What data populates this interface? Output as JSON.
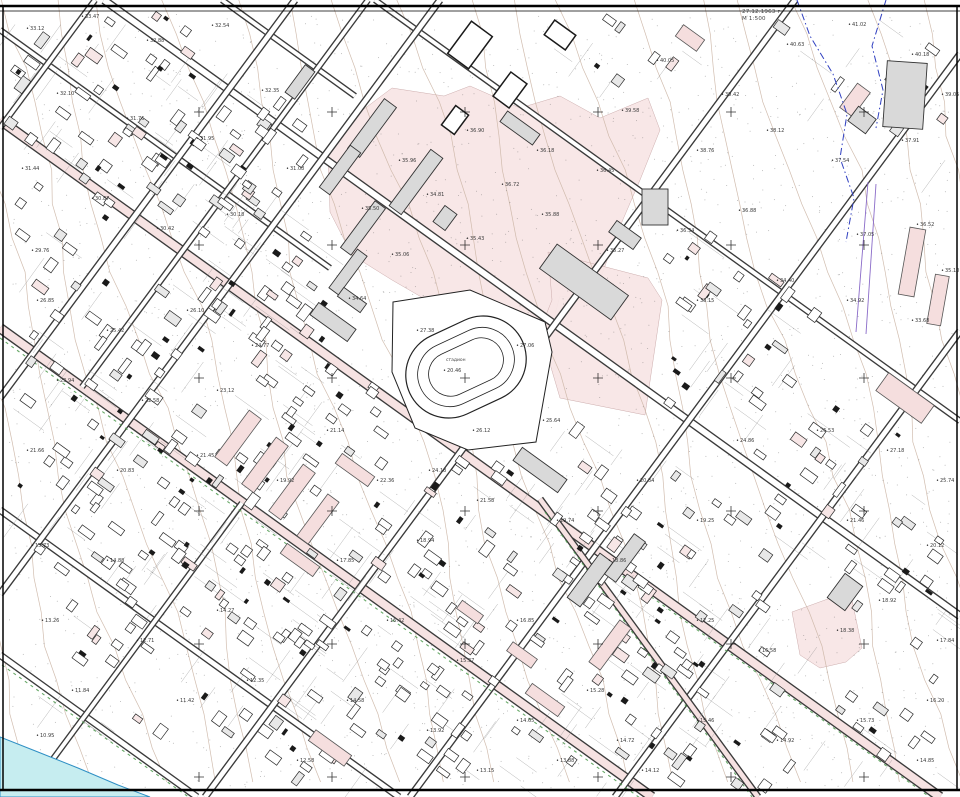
{
  "map": {
    "width": 960,
    "height": 797,
    "colors": {
      "background": "#ffffff",
      "zone_pink": "#f8e6e6",
      "road_tint": "#f6e2e2",
      "building_gray": "#d9d9d9",
      "building_outline": "#333333",
      "contour": "#ccb6a6",
      "water_fill": "#c6edf0",
      "water_edge": "#2e8fc4",
      "vegetation_green": "#4d9a4d",
      "boundary_blue": "#2f3fc0",
      "utility_purple": "#8a6bc8",
      "label_text": "#3b3b3b",
      "frame_black": "#000000"
    },
    "annotation": {
      "line1": "27.12.1963 г.",
      "line2": "М 1:500"
    },
    "stadium": {
      "label": "стадион",
      "center_elev": "20.46",
      "cx": 466,
      "cy": 367,
      "angle": -25,
      "rings": [
        [
          124,
          86
        ],
        [
          100,
          64
        ],
        [
          78,
          44
        ]
      ],
      "fence": [
        [
          393,
          302
        ],
        [
          470,
          290
        ],
        [
          545,
          322
        ],
        [
          552,
          352
        ],
        [
          536,
          442
        ],
        [
          468,
          450
        ],
        [
          415,
          428
        ],
        [
          392,
          372
        ]
      ]
    },
    "zones": [
      [
        [
          328,
          155
        ],
        [
          352,
          118
        ],
        [
          392,
          88
        ],
        [
          444,
          96
        ],
        [
          470,
          86
        ],
        [
          520,
          108
        ],
        [
          560,
          96
        ],
        [
          600,
          118
        ],
        [
          648,
          98
        ],
        [
          660,
          130
        ],
        [
          640,
          180
        ],
        [
          615,
          238
        ],
        [
          600,
          280
        ],
        [
          585,
          300
        ],
        [
          560,
          296
        ],
        [
          548,
          340
        ],
        [
          520,
          338
        ],
        [
          470,
          305
        ],
        [
          430,
          302
        ],
        [
          392,
          280
        ],
        [
          352,
          255
        ],
        [
          330,
          212
        ]
      ],
      [
        [
          548,
          252
        ],
        [
          648,
          278
        ],
        [
          662,
          300
        ],
        [
          645,
          415
        ],
        [
          560,
          398
        ],
        [
          540,
          330
        ],
        [
          552,
          300
        ]
      ],
      [
        [
          792,
          612
        ],
        [
          836,
          596
        ],
        [
          852,
          600
        ],
        [
          862,
          648
        ],
        [
          846,
          662
        ],
        [
          820,
          668
        ],
        [
          800,
          655
        ]
      ]
    ],
    "pink_bars": [
      [
        238,
        438,
        58,
        15,
        -53.5
      ],
      [
        265,
        465,
        58,
        15,
        -53.5
      ],
      [
        292,
        492,
        58,
        15,
        -53.5
      ],
      [
        318,
        519,
        52,
        14,
        -53.5
      ],
      [
        355,
        470,
        40,
        12,
        35.8
      ],
      [
        300,
        560,
        40,
        12,
        35.8
      ],
      [
        330,
        748,
        44,
        13,
        35.8
      ],
      [
        545,
        700,
        40,
        12,
        35.8
      ],
      [
        610,
        645,
        52,
        14,
        -53.5
      ],
      [
        470,
        612,
        26,
        10,
        35.8
      ],
      [
        522,
        655,
        30,
        11,
        35.8
      ],
      [
        912,
        262,
        16,
        68,
        10
      ],
      [
        938,
        300,
        14,
        50,
        10
      ],
      [
        905,
        398,
        56,
        22,
        35.8
      ],
      [
        855,
        100,
        30,
        16,
        -53.5
      ],
      [
        690,
        38,
        26,
        14,
        35.8
      ]
    ],
    "gray_buildings": [
      [
        372,
        128,
        62,
        15,
        -53.5
      ],
      [
        340,
        170,
        52,
        13,
        -53.5
      ],
      [
        416,
        182,
        70,
        15,
        -53.5
      ],
      [
        363,
        228,
        58,
        13,
        -53.5
      ],
      [
        348,
        272,
        48,
        12,
        -53.5
      ],
      [
        300,
        82,
        34,
        12,
        -53.5
      ],
      [
        445,
        218,
        20,
        15,
        -53.5
      ],
      [
        520,
        128,
        40,
        13,
        35.8
      ],
      [
        584,
        282,
        88,
        30,
        35.8
      ],
      [
        625,
        235,
        30,
        14,
        35.8
      ],
      [
        655,
        207,
        26,
        36,
        0
      ],
      [
        905,
        95,
        40,
        66,
        4
      ],
      [
        862,
        120,
        18,
        22,
        -53.5
      ],
      [
        333,
        322,
        46,
        15,
        35.8
      ],
      [
        352,
        300,
        28,
        11,
        35.8
      ],
      [
        845,
        592,
        30,
        22,
        -53.5
      ],
      [
        590,
        580,
        55,
        16,
        -53.5
      ],
      [
        625,
        558,
        50,
        14,
        -53.5
      ],
      [
        540,
        470,
        55,
        16,
        35.8
      ]
    ],
    "outline_buildings": [
      [
        470,
        45,
        40,
        26,
        -53.5
      ],
      [
        510,
        90,
        30,
        20,
        -53.5
      ],
      [
        455,
        120,
        24,
        16,
        -53.5
      ],
      [
        560,
        35,
        26,
        18,
        35.8
      ]
    ],
    "streets": [
      {
        "pts": [
          [
            104,
            0
          ],
          [
            960,
            616
          ]
        ],
        "w": 7,
        "tint": false
      },
      {
        "pts": [
          [
            0,
            120
          ],
          [
            940,
            797
          ]
        ],
        "w": 9,
        "tint": true
      },
      {
        "pts": [
          [
            0,
            328
          ],
          [
            652,
            797
          ]
        ],
        "w": 9,
        "tint": true
      },
      {
        "pts": [
          [
            0,
            510
          ],
          [
            399,
            797
          ]
        ],
        "w": 6,
        "tint": false
      },
      {
        "pts": [
          [
            0,
            655
          ],
          [
            197,
            797
          ]
        ],
        "w": 6,
        "tint": false
      },
      {
        "pts": [
          [
            375,
            0
          ],
          [
            960,
            421
          ]
        ],
        "w": 5,
        "tint": false
      },
      {
        "pts": [
          [
            0,
            30
          ],
          [
            330,
            268
          ]
        ],
        "w": 5,
        "tint": false
      },
      {
        "pts": [
          [
            222,
            0
          ],
          [
            355,
            96
          ]
        ],
        "w": 5,
        "tint": false
      },
      {
        "pts": [
          [
            95,
            0
          ],
          [
            0,
            128
          ]
        ],
        "w": 5,
        "tint": false
      },
      {
        "pts": [
          [
            295,
            0
          ],
          [
            0,
            398
          ]
        ],
        "w": 6,
        "tint": false
      },
      {
        "pts": [
          [
            440,
            0
          ],
          [
            0,
            594
          ]
        ],
        "w": 6,
        "tint": false
      },
      {
        "pts": [
          [
            795,
            0
          ],
          [
            205,
            797
          ]
        ],
        "w": 6,
        "tint": false
      },
      {
        "pts": [
          [
            960,
            54
          ],
          [
            410,
            797
          ]
        ],
        "w": 6,
        "tint": false
      },
      {
        "pts": [
          [
            960,
            331
          ],
          [
            615,
            797
          ]
        ],
        "w": 6,
        "tint": false
      },
      {
        "pts": [
          [
            242,
            503
          ],
          [
            25,
            797
          ]
        ],
        "w": 5,
        "tint": false
      },
      {
        "pts": [
          [
            368,
            0
          ],
          [
            82,
            387
          ]
        ],
        "w": 5,
        "tint": false
      },
      {
        "pts": [
          [
            540,
            499
          ],
          [
            758,
            797
          ]
        ],
        "w": 6,
        "tint": true
      }
    ],
    "green_lines": [
      [
        [
          600,
          560
        ],
        [
          945,
          808
        ]
      ],
      [
        [
          0,
          338
        ],
        [
          640,
          798
        ]
      ],
      [
        [
          545,
          512
        ],
        [
          752,
          797
        ]
      ],
      [
        [
          2,
          665
        ],
        [
          190,
          798
        ]
      ]
    ],
    "water": [
      [
        0,
        737
      ],
      [
        38,
        752
      ],
      [
        78,
        768
      ],
      [
        118,
        785
      ],
      [
        150,
        797
      ],
      [
        0,
        797
      ]
    ],
    "boundary_blue_paths": [
      [
        [
          797,
          0
        ],
        [
          810,
          36
        ],
        [
          833,
          74
        ],
        [
          847,
          114
        ],
        [
          840,
          158
        ],
        [
          854,
          198
        ],
        [
          846,
          242
        ]
      ],
      [
        [
          886,
          0
        ],
        [
          872,
          46
        ],
        [
          883,
          90
        ],
        [
          876,
          128
        ]
      ]
    ],
    "utility_lines": [
      [
        [
          868,
          182
        ],
        [
          856,
          332
        ]
      ],
      [
        [
          876,
          184
        ],
        [
          866,
          334
        ]
      ]
    ],
    "grid_crosses": {
      "xs": [
        199,
        332,
        465,
        598,
        731,
        864
      ],
      "ys": [
        112,
        245,
        378,
        511,
        644,
        777
      ]
    },
    "house_blocks": [
      [
        150,
        75,
        190,
        65,
        55
      ],
      [
        165,
        205,
        240,
        70,
        60
      ],
      [
        130,
        355,
        210,
        72,
        50
      ],
      [
        150,
        515,
        240,
        78,
        55
      ],
      [
        270,
        655,
        260,
        88,
        65
      ],
      [
        480,
        690,
        240,
        80,
        60
      ],
      [
        760,
        700,
        240,
        85,
        50
      ],
      [
        800,
        480,
        210,
        100,
        48
      ],
      [
        380,
        520,
        150,
        60,
        35
      ],
      [
        295,
        330,
        130,
        52,
        26
      ],
      [
        880,
        75,
        110,
        55,
        14
      ],
      [
        690,
        300,
        130,
        70,
        26
      ],
      [
        565,
        480,
        130,
        60,
        30
      ],
      [
        640,
        600,
        120,
        70,
        30
      ],
      [
        90,
        680,
        100,
        45,
        10
      ],
      [
        920,
        600,
        90,
        60,
        16
      ],
      [
        620,
        50,
        60,
        40,
        8
      ]
    ],
    "contours": {
      "count": 22,
      "start": -240,
      "spacing": 58,
      "drift": 0.28,
      "amp": 12,
      "wave": 90
    },
    "dot_count": 2600,
    "elevation_labels": [
      [
        30,
        30,
        "33.12"
      ],
      [
        85,
        18,
        "33.47"
      ],
      [
        150,
        42,
        "32.88"
      ],
      [
        215,
        27,
        "32.54"
      ],
      [
        60,
        95,
        "32.10"
      ],
      [
        130,
        120,
        "31.76"
      ],
      [
        25,
        170,
        "31.44"
      ],
      [
        200,
        140,
        "31.95"
      ],
      [
        95,
        200,
        "30.87"
      ],
      [
        265,
        92,
        "32.35"
      ],
      [
        160,
        230,
        "30.42"
      ],
      [
        35,
        252,
        "29.76"
      ],
      [
        230,
        216,
        "30.18"
      ],
      [
        290,
        170,
        "31.08"
      ],
      [
        365,
        210,
        "35.50"
      ],
      [
        402,
        162,
        "35.96"
      ],
      [
        430,
        196,
        "34.81"
      ],
      [
        505,
        186,
        "36.72"
      ],
      [
        540,
        152,
        "36.18"
      ],
      [
        470,
        240,
        "35.43"
      ],
      [
        395,
        256,
        "35.06"
      ],
      [
        352,
        300,
        "34.64"
      ],
      [
        545,
        216,
        "35.88"
      ],
      [
        600,
        172,
        "36.45"
      ],
      [
        470,
        132,
        "36.90"
      ],
      [
        610,
        252,
        "35.27"
      ],
      [
        660,
        62,
        "40.05"
      ],
      [
        725,
        96,
        "39.42"
      ],
      [
        790,
        46,
        "40.63"
      ],
      [
        852,
        26,
        "41.02"
      ],
      [
        915,
        56,
        "40.18"
      ],
      [
        700,
        152,
        "38.76"
      ],
      [
        770,
        132,
        "38.12"
      ],
      [
        835,
        162,
        "37.54"
      ],
      [
        905,
        142,
        "37.91"
      ],
      [
        945,
        96,
        "39.05"
      ],
      [
        625,
        112,
        "39.58"
      ],
      [
        680,
        232,
        "36.34"
      ],
      [
        742,
        212,
        "36.88"
      ],
      [
        860,
        236,
        "37.05"
      ],
      [
        920,
        226,
        "36.52"
      ],
      [
        700,
        302,
        "33.15"
      ],
      [
        780,
        282,
        "34.40"
      ],
      [
        850,
        302,
        "34.92"
      ],
      [
        915,
        322,
        "33.68"
      ],
      [
        945,
        272,
        "35.10"
      ],
      [
        447,
        372,
        "20.46"
      ],
      [
        520,
        347,
        "27.06"
      ],
      [
        420,
        332,
        "27.38"
      ],
      [
        476,
        432,
        "26.12"
      ],
      [
        546,
        422,
        "25.64"
      ],
      [
        432,
        472,
        "24.18"
      ],
      [
        40,
        302,
        "26.85"
      ],
      [
        110,
        332,
        "25.42"
      ],
      [
        190,
        312,
        "26.10"
      ],
      [
        255,
        347,
        "24.77"
      ],
      [
        60,
        382,
        "23.94"
      ],
      [
        145,
        402,
        "22.58"
      ],
      [
        220,
        392,
        "23.12"
      ],
      [
        30,
        452,
        "21.66"
      ],
      [
        120,
        472,
        "20.83"
      ],
      [
        200,
        457,
        "21.45"
      ],
      [
        280,
        482,
        "19.92"
      ],
      [
        330,
        432,
        "21.14"
      ],
      [
        35,
        547,
        "15.73"
      ],
      [
        110,
        562,
        "14.88"
      ],
      [
        45,
        622,
        "13.26"
      ],
      [
        140,
        642,
        "12.71"
      ],
      [
        75,
        692,
        "11.84"
      ],
      [
        180,
        702,
        "11.42"
      ],
      [
        40,
        737,
        "10.95"
      ],
      [
        220,
        612,
        "14.27"
      ],
      [
        250,
        682,
        "12.35"
      ],
      [
        340,
        562,
        "17.85"
      ],
      [
        420,
        542,
        "18.94"
      ],
      [
        390,
        622,
        "16.42"
      ],
      [
        460,
        662,
        "15.37"
      ],
      [
        520,
        622,
        "16.85"
      ],
      [
        350,
        702,
        "14.58"
      ],
      [
        430,
        732,
        "13.92"
      ],
      [
        520,
        722,
        "14.65"
      ],
      [
        590,
        692,
        "15.28"
      ],
      [
        480,
        772,
        "13.15"
      ],
      [
        560,
        762,
        "13.88"
      ],
      [
        620,
        742,
        "14.72"
      ],
      [
        300,
        762,
        "12.58"
      ],
      [
        380,
        482,
        "22.36"
      ],
      [
        480,
        502,
        "21.58"
      ],
      [
        560,
        522,
        "19.74"
      ],
      [
        612,
        562,
        "18.86"
      ],
      [
        640,
        482,
        "20.34"
      ],
      [
        700,
        522,
        "19.25"
      ],
      [
        700,
        622,
        "17.25"
      ],
      [
        762,
        652,
        "16.58"
      ],
      [
        840,
        632,
        "18.38"
      ],
      [
        882,
        602,
        "18.92"
      ],
      [
        940,
        642,
        "17.84"
      ],
      [
        700,
        722,
        "15.46"
      ],
      [
        780,
        742,
        "14.92"
      ],
      [
        860,
        722,
        "15.73"
      ],
      [
        930,
        702,
        "16.20"
      ],
      [
        920,
        762,
        "14.85"
      ],
      [
        645,
        772,
        "14.12"
      ],
      [
        740,
        442,
        "24.86"
      ],
      [
        820,
        432,
        "26.53"
      ],
      [
        890,
        452,
        "27.18"
      ],
      [
        940,
        482,
        "25.74"
      ],
      [
        850,
        522,
        "21.46"
      ],
      [
        930,
        547,
        "20.12"
      ]
    ]
  }
}
